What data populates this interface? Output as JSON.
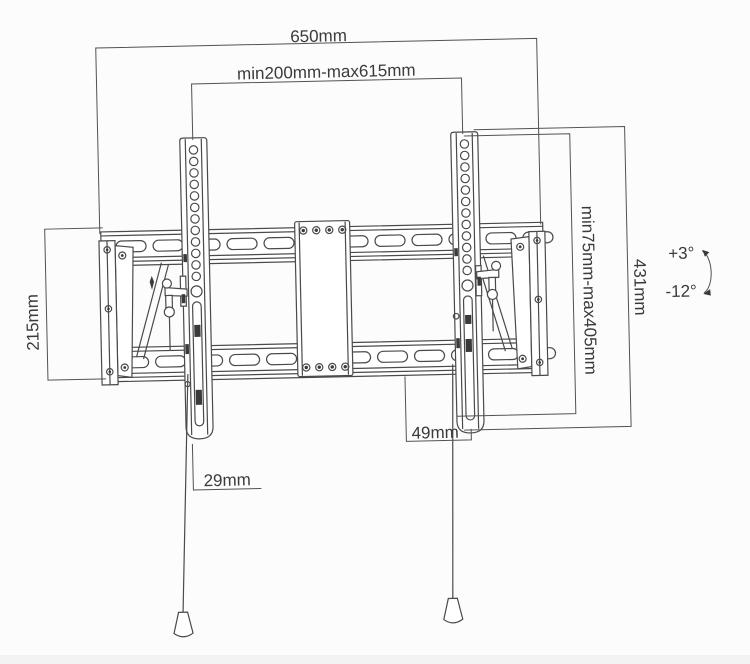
{
  "diagram": {
    "dimensions": {
      "total_width": "650mm",
      "mount_width_range": "min200mm-max615mm",
      "wall_plate_height": "215mm",
      "vesa_height_range": "min75mm-max405mm",
      "bracket_height": "431mm",
      "bottom_offset": "49mm",
      "bracket_bottom_width": "29mm"
    },
    "tilt": {
      "up_label": "+3°",
      "down_label": "-12°"
    },
    "colors": {
      "line": "#4a4a4a",
      "dimension_line": "#525252",
      "text": "#3a3a3a",
      "background": "#fcfcfc"
    }
  }
}
